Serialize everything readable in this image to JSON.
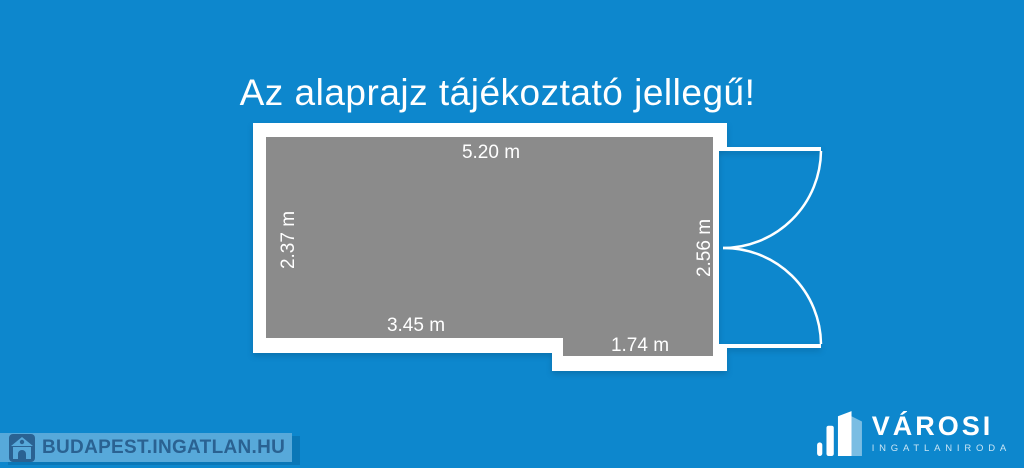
{
  "title": {
    "text": "Az alaprajz tájékoztató jellegű!"
  },
  "floorplan": {
    "dimensions": {
      "top": "5.20 m",
      "left": "2.37 m",
      "right": "2.56 m",
      "bottom_left": "3.45 m",
      "bottom_right": "1.74 m"
    },
    "features": {
      "door": "double-swing-door-right"
    }
  },
  "watermark": {
    "text": "BUDAPEST.INGATLAN.HU",
    "icon": "house-icon"
  },
  "agency": {
    "name": "VÁROSI",
    "subtitle": "INGATLANIRODA",
    "icon": "city-buildings-icon"
  },
  "colors": {
    "background": "#0d87cd",
    "wall": "#ffffff",
    "room_fill": "#8b8b8b",
    "watermark_band": "#57a9da",
    "watermark_text": "#2a6292",
    "logo_text": "#ffffff"
  }
}
